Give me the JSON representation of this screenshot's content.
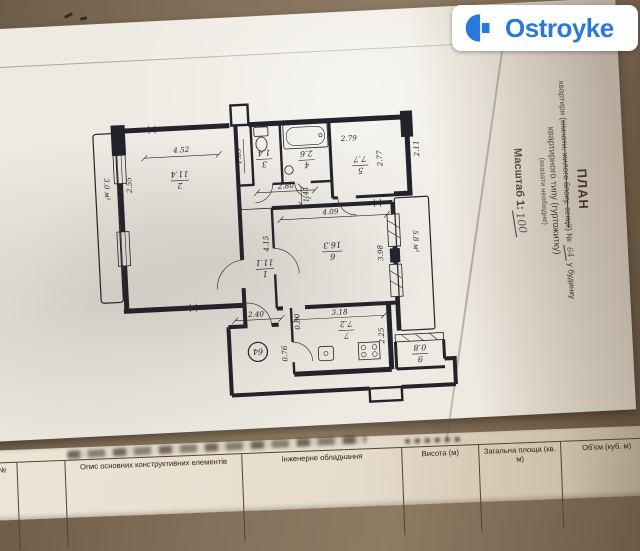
{
  "logo": {
    "name": "Ostroyke",
    "color": "#2b78dd"
  },
  "title": {
    "heading": "ПЛАН",
    "line2_prefix": "квартири (",
    "line2_struck": "кімнати, жилого блоку, секції",
    "line2_suffix": ") №",
    "apt_number": "64",
    "line2_tail": "у будинку",
    "line3": "квартирного типу (гуртожитку)",
    "line4": "(вказати необхідне)",
    "scale_prefix": "Масштаб 1:",
    "scale_value": "100"
  },
  "plan": {
    "rooms": {
      "r1": {
        "num": "1",
        "area": "11.1"
      },
      "r2": {
        "num": "2",
        "area": "11.4"
      },
      "r3": {
        "num": "3",
        "area": "1.4"
      },
      "r4": {
        "num": "4",
        "area": "2.6"
      },
      "r5": {
        "num": "5",
        "area": "7.7"
      },
      "r6": {
        "num": "6",
        "area": "16.3"
      },
      "r7": {
        "num": "7",
        "area": "7.2"
      },
      "r9": {
        "num": "9",
        "area": "0.8"
      }
    },
    "balconies": {
      "left": "3.0 м²",
      "right": "5.8 м²"
    },
    "apartment_circle": "64",
    "dims": {
      "w452": "4.52",
      "w255": "2.55",
      "w165": "1.65",
      "w280": "2.80",
      "w141": "1.41",
      "w279": "2.79",
      "w277": "2.77",
      "w211": "2.11",
      "w409": "4.09",
      "w415": "4.15",
      "w398": "3.98",
      "w318": "3.18",
      "w240": "2.40",
      "w080": "0.80",
      "w076": "0.76",
      "w225": "2.25"
    }
  },
  "table": {
    "col_no": "№",
    "col_desc": "Опис основних конструктивних елементів",
    "col_equip": "Інженерне обладнання",
    "col_height": "Висота (м)",
    "col_area": "Загальна площа (кв. м)",
    "col_volume": "Об'єм (куб. м)"
  },
  "colors": {
    "ink": "#24232c",
    "paper": "#edeae2",
    "table_surface": "#83705a"
  }
}
